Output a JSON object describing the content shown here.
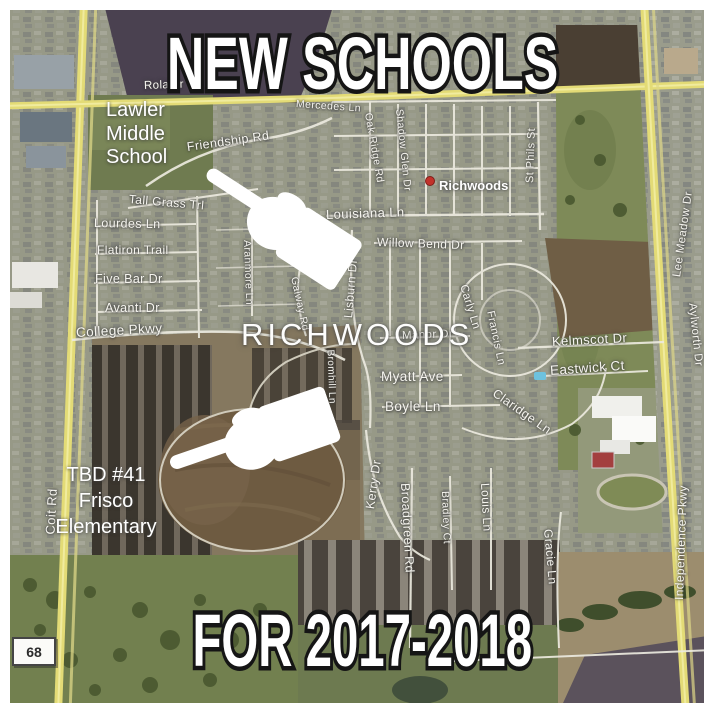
{
  "titles": {
    "top": "NEW SCHOOLS",
    "bottom": "FOR 2017-2018"
  },
  "annotations": {
    "lawler": {
      "lines": [
        "Lawler",
        "Middle",
        "School"
      ]
    },
    "tbd": {
      "lines": [
        "TBD #41",
        "Frisco",
        "Elementary"
      ]
    }
  },
  "neighborhood_label": "RICHWOODS",
  "poi": {
    "richwoods": "Richwoods"
  },
  "road_shield": "68",
  "icons": {
    "pointer_upper": "white-pointing-hand-icon",
    "pointer_lower": "white-pointing-hand-icon",
    "poi_marker": "red-dot-marker"
  },
  "colors": {
    "road_yellow": "#e3db76",
    "marker_red": "#c2322b",
    "title_fill": "#ffffff",
    "title_outline": "#151515",
    "label_white": "#f6f5ef"
  },
  "streets": [
    {
      "t": "Rolater",
      "x": 144,
      "y": 80,
      "r": -2,
      "s": 11.5
    },
    {
      "t": "Friendship Rd",
      "x": 187,
      "y": 140,
      "r": -8,
      "s": 12.5
    },
    {
      "t": "Tall Grass Trl",
      "x": 129,
      "y": 192,
      "r": 5,
      "s": 12
    },
    {
      "t": "Lourdes Ln",
      "x": 94,
      "y": 216,
      "r": 1,
      "s": 12.5
    },
    {
      "t": "Flatiron Trail",
      "x": 97,
      "y": 243,
      "r": 0,
      "s": 12
    },
    {
      "t": "Five Bar Dr",
      "x": 95,
      "y": 272,
      "r": 0,
      "s": 12.5
    },
    {
      "t": "Avanti Dr",
      "x": 105,
      "y": 301,
      "r": 0,
      "s": 12.5
    },
    {
      "t": "College Pkwy",
      "x": 76,
      "y": 325,
      "r": -3,
      "s": 13.5
    },
    {
      "t": "Mercedes Ln",
      "x": 296,
      "y": 98,
      "r": 4,
      "s": 10.5
    },
    {
      "t": "Oak Ridge Rd",
      "x": 368,
      "y": 107,
      "r": 80,
      "s": 10.5
    },
    {
      "t": "Shadow Glen Dr",
      "x": 399,
      "y": 103,
      "r": 84,
      "s": 10.5
    },
    {
      "t": "Louisiana Ln",
      "x": 326,
      "y": 207,
      "r": -2,
      "s": 13
    },
    {
      "t": "St Phils St",
      "x": 530,
      "y": 177,
      "r": -88,
      "s": 11
    },
    {
      "t": "Willow Bend Dr",
      "x": 377,
      "y": 235,
      "r": 2,
      "s": 12
    },
    {
      "t": "Aranmore Ln",
      "x": 247,
      "y": 234,
      "r": 88,
      "s": 10.5
    },
    {
      "t": "Galway Rd",
      "x": 294,
      "y": 271,
      "r": 78,
      "s": 10.5
    },
    {
      "t": "Lisburn Dr",
      "x": 348,
      "y": 311,
      "r": -85,
      "s": 12
    },
    {
      "t": "Bromhill Ln",
      "x": 330,
      "y": 344,
      "r": 88,
      "s": 10
    },
    {
      "t": "Manor Dr",
      "x": 402,
      "y": 330,
      "r": -2,
      "s": 11.5
    },
    {
      "t": "Myatt Ave",
      "x": 381,
      "y": 369,
      "r": 0,
      "s": 13.5
    },
    {
      "t": "Boyle Ln",
      "x": 385,
      "y": 399,
      "r": 0,
      "s": 13.5
    },
    {
      "t": "Carly Ln",
      "x": 463,
      "y": 279,
      "r": 73,
      "s": 11.5
    },
    {
      "t": "Francis Ln",
      "x": 490,
      "y": 305,
      "r": 78,
      "s": 11
    },
    {
      "t": "Claridge Ln",
      "x": 494,
      "y": 385,
      "r": 35,
      "s": 12.5
    },
    {
      "t": "Kelmscot Dr",
      "x": 552,
      "y": 334,
      "r": -3,
      "s": 13
    },
    {
      "t": "Eastwick Ct",
      "x": 550,
      "y": 363,
      "r": -4,
      "s": 13.5
    },
    {
      "t": "Kerry Dr",
      "x": 370,
      "y": 502,
      "r": -82,
      "s": 12.5
    },
    {
      "t": "Broadgreen Rd",
      "x": 405,
      "y": 476,
      "r": 87,
      "s": 12.5
    },
    {
      "t": "Bradley Ct",
      "x": 445,
      "y": 485,
      "r": 88,
      "s": 10.5
    },
    {
      "t": "Louis Ln",
      "x": 485,
      "y": 476,
      "r": 87,
      "s": 12
    },
    {
      "t": "Gracie Ln",
      "x": 548,
      "y": 522,
      "r": 85,
      "s": 12
    },
    {
      "t": "Coit Rd",
      "x": 50,
      "y": 527,
      "r": -87,
      "s": 13
    },
    {
      "t": "Lee Meadow Dr",
      "x": 677,
      "y": 271,
      "r": -82,
      "s": 11.5
    },
    {
      "t": "Aylworth Dr",
      "x": 692,
      "y": 297,
      "r": 84,
      "s": 11.5
    },
    {
      "t": "Independence Pkwy",
      "x": 679,
      "y": 593,
      "r": -88,
      "s": 12
    }
  ]
}
